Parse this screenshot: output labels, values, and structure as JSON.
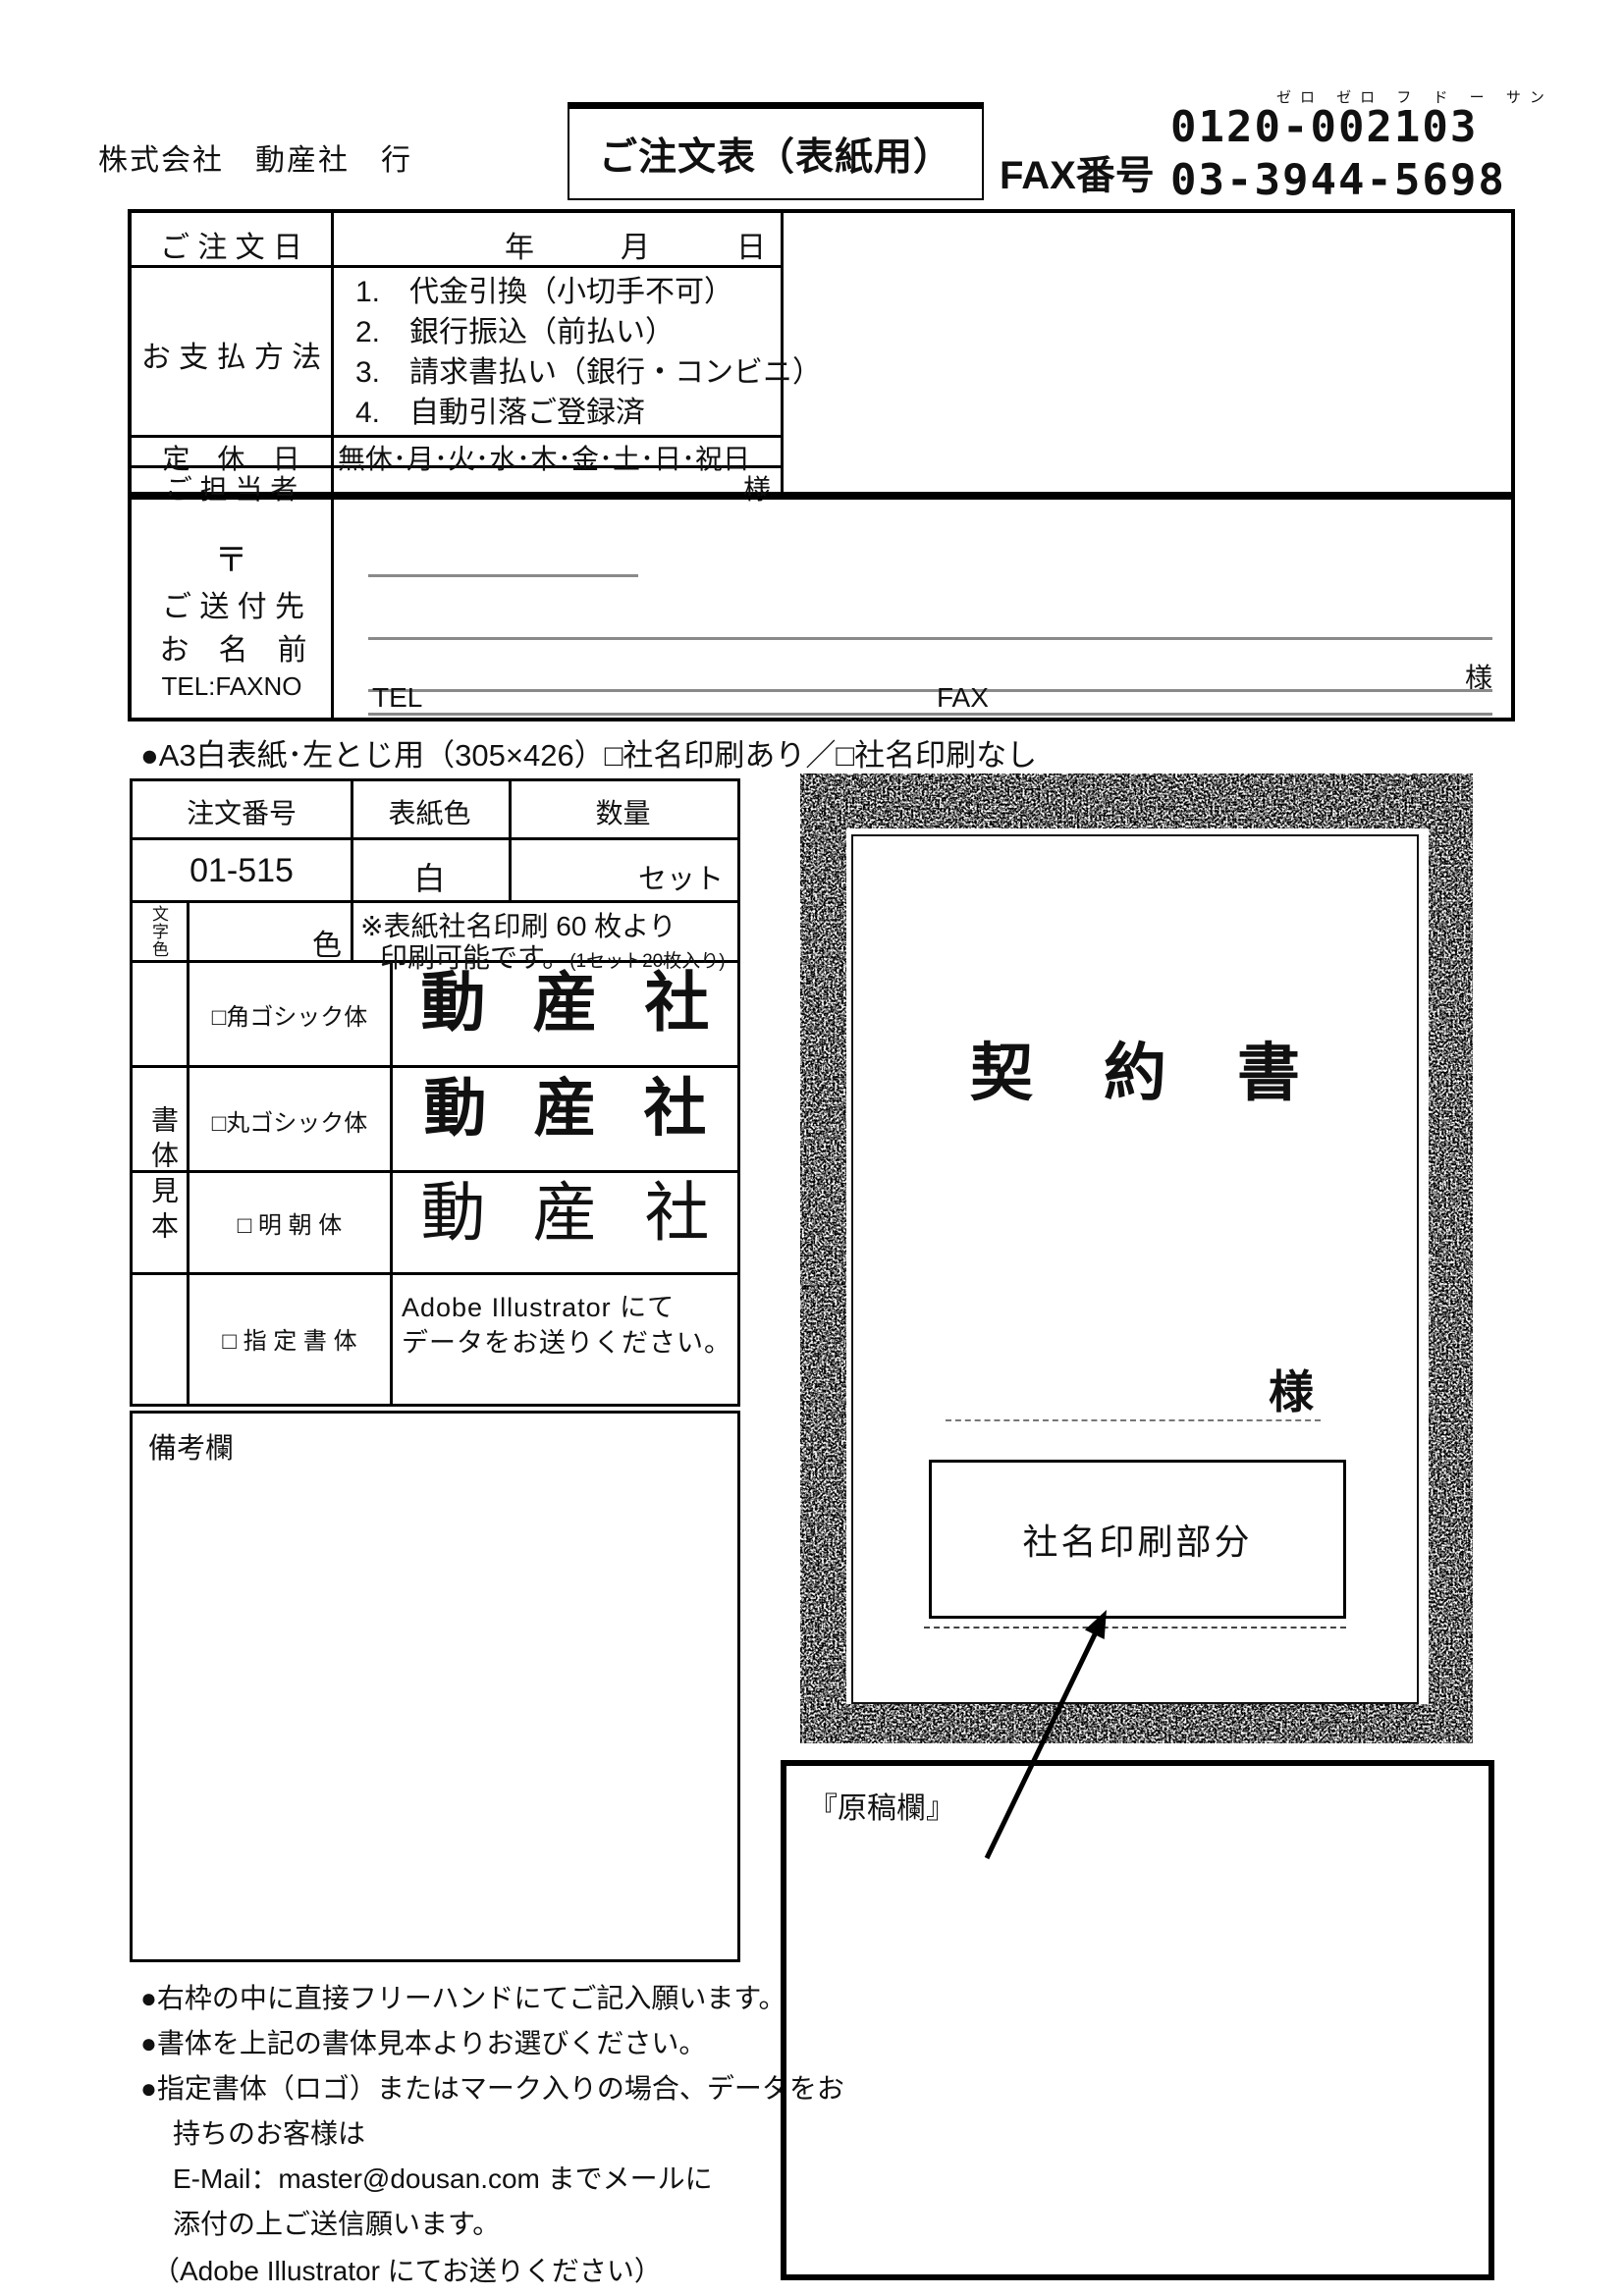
{
  "header": {
    "addressee": "株式会社　動産社　行",
    "title": "ご注文表（表紙用）",
    "fax_label": "FAX番号",
    "fax_furigana": "ゼロ ゼロ フ ド ー サン",
    "fax_number_toll_free": "0120-002103",
    "fax_number_local": "03-3944-5698"
  },
  "order_info": {
    "order_date_label": "ご 注 文 日",
    "date_units": {
      "year": "年",
      "month": "月",
      "day": "日"
    },
    "payment_label": "お 支 払 方 法",
    "payment_options": [
      "1.　代金引換（小切手不可）",
      "2.　銀行振込（前払い）",
      "3.　請求書払い（銀行・コンビニ）",
      "4.　自動引落ご登録済"
    ],
    "holiday_label": "定　休　日",
    "holiday_options": "無休･月･火･水･木･金･土･日･祝日",
    "contact_label": "ご 担 当 者",
    "contact_suffix": "様"
  },
  "shipping": {
    "postal_mark": "〒",
    "recipient_label": "ご 送 付 先",
    "name_label": "お　名　前",
    "telfax_label": "TEL:FAXNO",
    "name_suffix": "様",
    "tel_label": "TEL",
    "fax_label": "FAX"
  },
  "section_a3": {
    "heading": "●A3白表紙･左とじ用（305×426）□社名印刷あり／□社名印刷なし"
  },
  "spec": {
    "headers": {
      "order_no": "注文番号",
      "cover_color": "表紙色",
      "quantity": "数量"
    },
    "order_no": "01-515",
    "cover_color": "白",
    "quantity_unit": "セット",
    "text_color_label": "文字色",
    "color_suffix": "色",
    "note_line1": "※表紙社名印刷 60 枚より",
    "note_line2": "印刷可能です。",
    "note_line2_paren": "(1セット20枚入り)"
  },
  "font_samples": {
    "group_label": "書体見本",
    "square_gothic_label": "□角ゴシック体",
    "round_gothic_label": "□丸ゴシック体",
    "mincho_label": "□ 明 朝 体",
    "custom_label": "□ 指 定 書 体",
    "sample_text": "動産社",
    "custom_note1": "Adobe Illustrator にて",
    "custom_note2": "データをお送りください。"
  },
  "remarks": {
    "label": "備考欄"
  },
  "notes": [
    "●右枠の中に直接フリーハンドにてご記入願います。",
    "●書体を上記の書体見本よりお選びください。",
    "●指定書体（ロゴ）またはマーク入りの場合、データをお",
    "持ちのお客様は",
    "E-Mail：master@dousan.com までメールに",
    "添付の上ご送信願います。",
    "（Adobe Illustrator にてお送りください）"
  ],
  "cover_preview": {
    "title": "契約書",
    "name_suffix": "様",
    "company_print_label": "社名印刷部分"
  },
  "draft_area": {
    "label": "『原稿欄』"
  }
}
